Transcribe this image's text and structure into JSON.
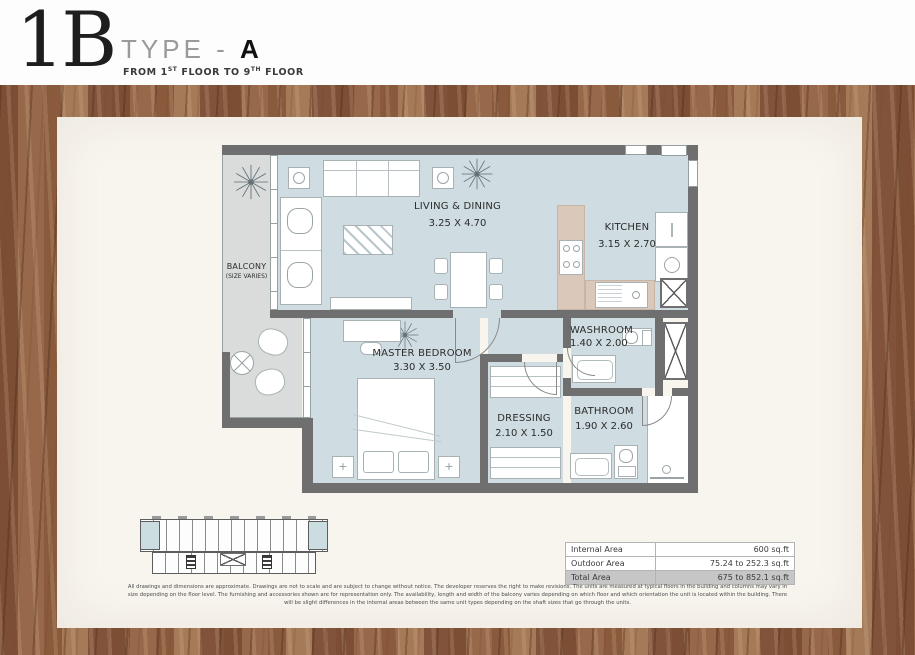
{
  "title": {
    "code": "1B",
    "type_prefix": "TYPE - ",
    "type_value": "A",
    "floor_pre": "FROM 1",
    "floor_sup1": "ST",
    "floor_mid": " FLOOR TO 9",
    "floor_sup2": "TH",
    "floor_post": " FLOOR"
  },
  "rooms": {
    "balcony": {
      "name": "BALCONY",
      "note": "(SIZE VARIES)"
    },
    "living": {
      "name": "LIVING & DINING",
      "dims": "3.25 X 4.70"
    },
    "kitchen": {
      "name": "KITCHEN",
      "dims": "3.15 X 2.70"
    },
    "master": {
      "name": "MASTER BEDROOM",
      "dims": "3.30 X 3.50"
    },
    "dressing": {
      "name": "DRESSING",
      "dims": "2.10 X 1.50"
    },
    "washroom": {
      "name": "WASHROOM",
      "dims": "1.40 X 2.00"
    },
    "bathroom": {
      "name": "BATHROOM",
      "dims": "1.90 X 2.60"
    }
  },
  "area_table": {
    "rows": [
      {
        "label": "Internal Area",
        "value": "600 sq.ft"
      },
      {
        "label": "Outdoor Area",
        "value": "75.24 to 252.3 sq.ft"
      },
      {
        "label": "Total Area",
        "value": "675 to 852.1 sq.ft"
      }
    ]
  },
  "disclaimer": "All drawings and dimensions are approximate. Drawings are not to scale and are subject to change without notice. The developer reserves the right to make revisions. The units are measured at typical floors in the building and columns may vary in size depending on the floor level. The furnishing and accessories shown are for representation only. The availability, length and width of the balcony varies depending on which floor and which orientation the unit is located within the building. There will be slight differences in the internal areas between the same unit types depending on the shaft sizes that go through the units.",
  "colors": {
    "wall": "#6f6f6f",
    "floor": "#cfdce1",
    "balcony_floor": "#d9dcdb",
    "counter": "#dac9ba",
    "panel": "#f8f5ef",
    "highlight_unit": "#ccdde2"
  }
}
